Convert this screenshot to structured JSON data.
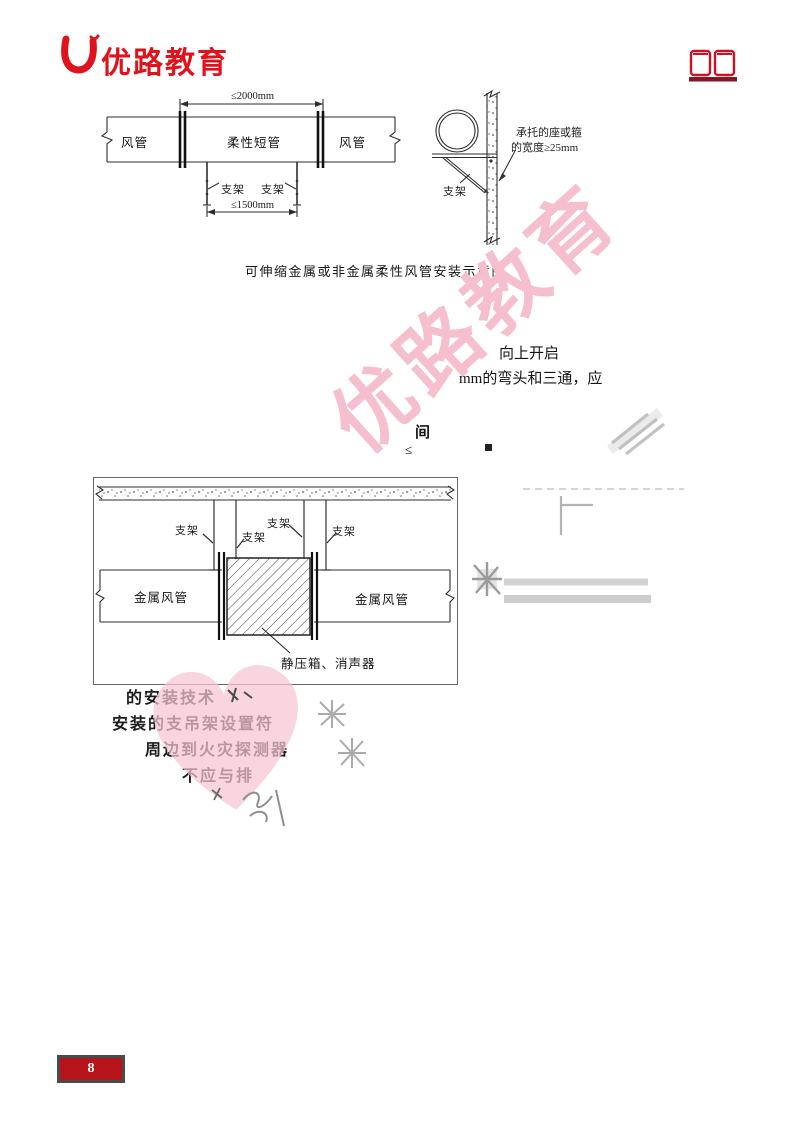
{
  "header": {
    "logo_text": "优路教育"
  },
  "figure1": {
    "caption": "可伸缩金属或非金属柔性风管安装示意图",
    "dim_top": "≤2000mm",
    "dim_bottom": "≤1500mm",
    "duct_left": "风管",
    "duct_mid": "柔性短管",
    "duct_right": "风管",
    "support_left": "支架",
    "support_right": "支架",
    "wall_support": "支架",
    "note_line1": "承托的座或箍",
    "note_line2": "的宽度≥25mm"
  },
  "figure2": {
    "caption": "静压箱、消声器",
    "duct_left": "金属风管",
    "duct_right": "金属风管",
    "support1": "支架",
    "support2": "支架",
    "support3": "支架",
    "support4": "支架"
  },
  "text_fragments": {
    "open_up": "向上开启",
    "elbow_tee": "mm的弯头和三通，应",
    "frag_jian": "间",
    "frag_leq": "≤",
    "line1": "的安装技术",
    "line2": "安装的支吊架设置符",
    "line3": "周边到火灾探测器",
    "line4": "不应与排"
  },
  "watermark": {
    "text": "优路教育"
  },
  "footer": {
    "page_number": "8"
  },
  "colors": {
    "logo_red": "#e0131d",
    "page_box_red": "#b6141b",
    "watermark_pink": "#f6bfce",
    "heart_pink": "#f7c6d3",
    "pencil_gray": "#a8a8a8"
  }
}
